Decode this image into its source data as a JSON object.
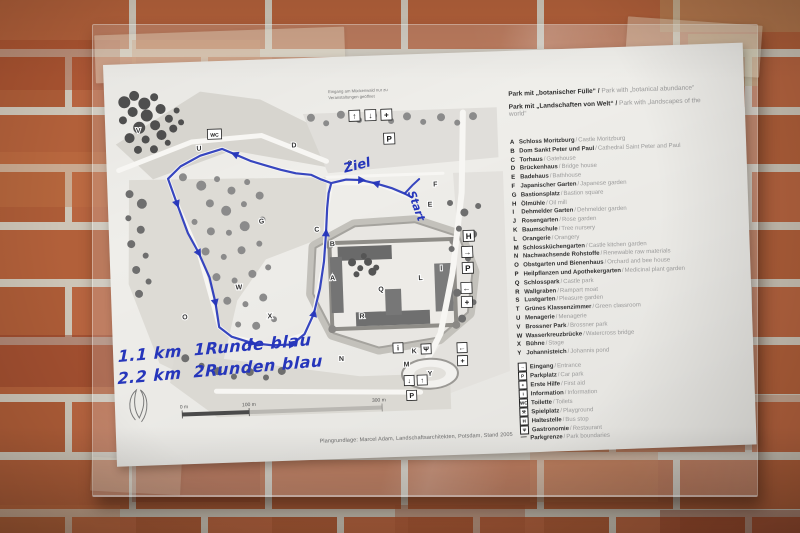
{
  "photo": {
    "wall_color": "#b2603a",
    "mortar_color": "#cdc5b7",
    "ink_color": "#2636bb"
  },
  "map": {
    "top_note": {
      "line1": "Eingang am Mückenwald nur zu",
      "line2": "Veranstaltungen geöffnet"
    },
    "letters": [
      "A",
      "B",
      "C",
      "D",
      "E",
      "F",
      "G",
      "I",
      "K",
      "L",
      "M",
      "N",
      "O",
      "Q",
      "R",
      "S",
      "U",
      "V",
      "W",
      "X",
      "Y"
    ],
    "glyphs": {
      "up": "↑",
      "down": "↓",
      "cross": "+",
      "p": "P",
      "h": "H",
      "left": "←",
      "right": "→",
      "info": "i",
      "wc": "WC",
      "food": "Ψ"
    },
    "scale": {
      "start": "0 m",
      "mid": "100 m",
      "end": "300 m"
    },
    "caption": "Plangrundlage: Marcel Adam, Landschaftsarchitekten, Potsdam, Stand 2005"
  },
  "route": {
    "label_finish": "Ziel",
    "label_start": "Start",
    "note_line1": "1.1 km  1Runde blau",
    "note_line2": "2.2 km  2Runden blau"
  },
  "legend": {
    "header": [
      {
        "de": "Park mit „botanischer Fülle“ /",
        "en": "Park with „botanical abundance“"
      },
      {
        "de": "Park mit „Landschaften von Welt“ /",
        "en": "Park with „landscapes of the world“"
      }
    ],
    "items": [
      {
        "letter": "A",
        "de": "Schloss Moritzburg",
        "en": "Castle Moritzburg"
      },
      {
        "letter": "B",
        "de": "Dom Sankt Peter und Paul",
        "en": "Cathedral Saint Peter and Paul"
      },
      {
        "letter": "C",
        "de": "Torhaus",
        "en": "Gatehouse"
      },
      {
        "letter": "D",
        "de": "Brückenhaus",
        "en": "Bridge house"
      },
      {
        "letter": "E",
        "de": "Badehaus",
        "en": "Bathhouse"
      },
      {
        "letter": "F",
        "de": "Japanischer Garten",
        "en": "Japanese garden"
      },
      {
        "letter": "G",
        "de": "Bastionsplatz",
        "en": "Bastion square"
      },
      {
        "letter": "H",
        "de": "Ölmühle",
        "en": "Oil mill"
      },
      {
        "letter": "I",
        "de": "Dehmelder Garten",
        "en": "Dehmelder garden"
      },
      {
        "letter": "J",
        "de": "Rosengarten",
        "en": "Rose garden"
      },
      {
        "letter": "K",
        "de": "Baumschule",
        "en": "Tree nursery"
      },
      {
        "letter": "L",
        "de": "Orangerie",
        "en": "Orangery"
      },
      {
        "letter": "M",
        "de": "Schlossküchengarten",
        "en": "Castle kitchen garden"
      },
      {
        "letter": "N",
        "de": "Nachwachsende Rohstoffe",
        "en": "Renewable raw materials"
      },
      {
        "letter": "O",
        "de": "Obstgarten und Bienenhaus",
        "en": "Orchard and bee house"
      },
      {
        "letter": "P",
        "de": "Heilpflanzen und Apothekergarten",
        "en": "Medicinal plant garden"
      },
      {
        "letter": "Q",
        "de": "Schlosspark",
        "en": "Castle park"
      },
      {
        "letter": "R",
        "de": "Wallgraben",
        "en": "Rampart moat"
      },
      {
        "letter": "S",
        "de": "Lustgarten",
        "en": "Pleasure garden"
      },
      {
        "letter": "T",
        "de": "Grünes Klassenzimmer",
        "en": "Green classroom"
      },
      {
        "letter": "U",
        "de": "Menagerie",
        "en": "Menagerie"
      },
      {
        "letter": "V",
        "de": "Brossner Park",
        "en": "Brossner park"
      },
      {
        "letter": "W",
        "de": "Wasserkreuzbrücke",
        "en": "Watercross bridge"
      },
      {
        "letter": "X",
        "de": "Bühne",
        "en": "Stage"
      },
      {
        "letter": "Y",
        "de": "Johannisteich",
        "en": "Johannis pond"
      }
    ],
    "icons": [
      {
        "glyph": "→",
        "de": "Eingang",
        "en": "Entrance"
      },
      {
        "glyph": "P",
        "de": "Parkplatz",
        "en": "Car park"
      },
      {
        "glyph": "+",
        "de": "Erste Hilfe",
        "en": "First aid"
      },
      {
        "glyph": "i",
        "de": "Information",
        "en": "Information"
      },
      {
        "glyph": "WC",
        "de": "Toilette",
        "en": "Toilets"
      },
      {
        "glyph": "⚒",
        "de": "Spielplatz",
        "en": "Playground"
      },
      {
        "glyph": "H",
        "de": "Haltestelle",
        "en": "Bus stop"
      },
      {
        "glyph": "Ψ",
        "de": "Gastronomie",
        "en": "Restaurant"
      },
      {
        "glyph": "—",
        "de": "Parkgrenze",
        "en": "Park boundaries"
      }
    ]
  }
}
